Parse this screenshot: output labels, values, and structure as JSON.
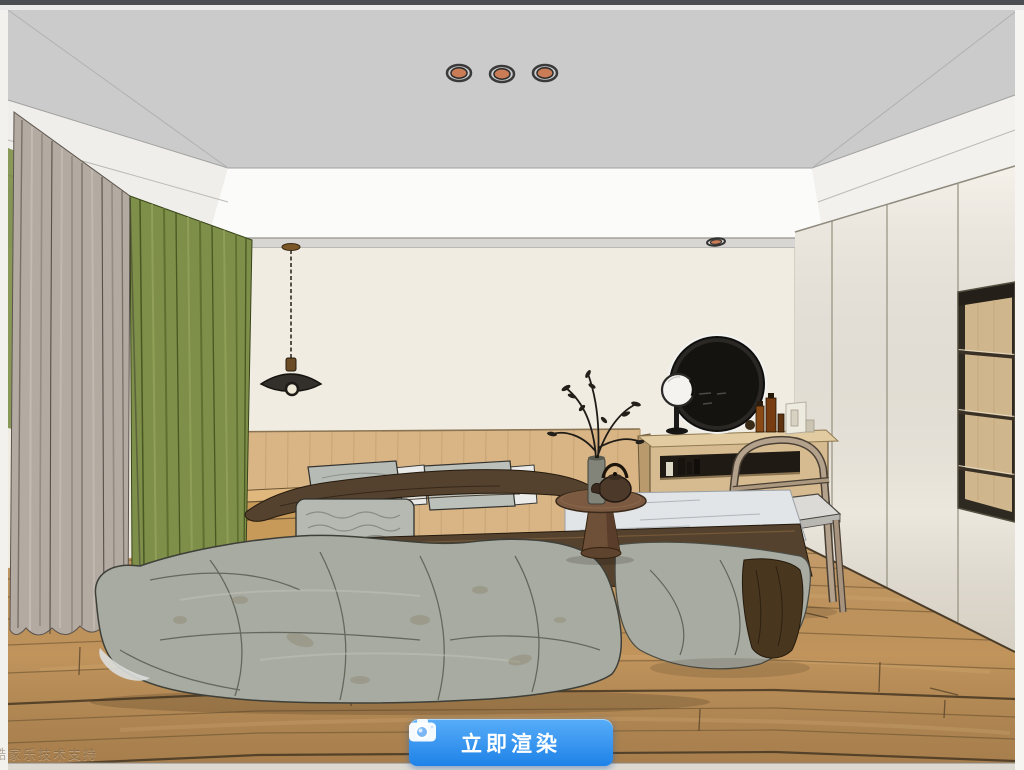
{
  "viewport": {
    "watermark": "酷家乐技术支持"
  },
  "render_button": {
    "label": "立即渲染",
    "icon": "camera-icon",
    "gradient_top": "#58adf8",
    "gradient_bottom": "#1e82e8",
    "text_color": "#ffffff"
  },
  "scene": {
    "type": "3d-room-preview",
    "room": "bedroom",
    "render_style": "sketch",
    "objects": [
      "ceiling-lightbox",
      "recessed-downlights",
      "pendant-lamp",
      "beige-curtain",
      "green-curtain",
      "bed",
      "pillows",
      "brown-blanket",
      "nightstand",
      "side-table",
      "teapot",
      "plant-vase",
      "vanity-desk",
      "round-black-mirror",
      "makeup-mirror",
      "cosmetics",
      "wood-chair",
      "wardrobe",
      "open-shelf-niche",
      "wood-floor",
      "wood-wainscot"
    ],
    "downlight_counts": {
      "ceiling_center": 3,
      "left_soffit": 2,
      "right_soffit": 1
    },
    "palette": {
      "ceiling": "#cbcbcb",
      "cove": "#fbfbf9",
      "wall": "#f1ece2",
      "panel": "#d9b586",
      "floor": "#c1945c",
      "beige": "#b3aaa2",
      "green": "#7d8f48",
      "duvet": "#a8aba1",
      "brown": "#55422e",
      "downlight": "#c97c55"
    }
  }
}
